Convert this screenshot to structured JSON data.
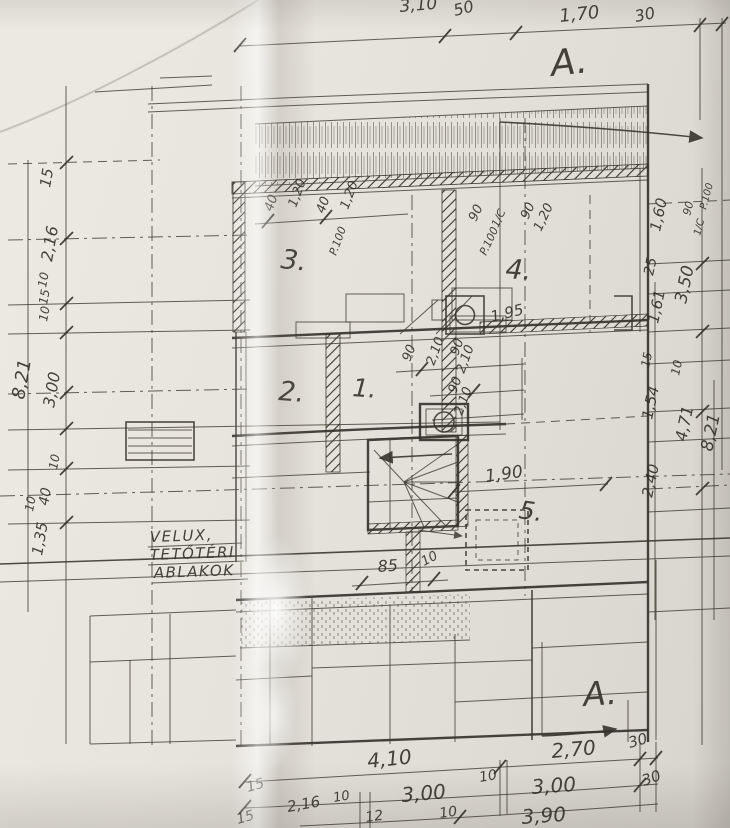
{
  "colors": {
    "paper": "#e7e4dd",
    "paper_bright": "#ece9e2",
    "ink": "#33302a",
    "pencil": "#4a473f"
  },
  "labels": {
    "section_marker": "A.",
    "rooms": {
      "r1": "1.",
      "r2": "2.",
      "r3": "3.",
      "r4": "4.",
      "r5": "5."
    },
    "note": {
      "l1": "VELUX,",
      "l2": "TETŐTÉRI",
      "l3": "ABLAKOK"
    }
  },
  "dims": {
    "top": {
      "d1": "3,10",
      "d2": "50",
      "d3": "1,70",
      "d4": "30"
    },
    "left": {
      "d1": "15",
      "d2": "2,16",
      "d3": "10",
      "d4": "15",
      "d5": "10",
      "d6": "3,00",
      "d7": "8,21",
      "d8": "10",
      "d9": "40",
      "d10": "10",
      "d11": "1,35"
    },
    "right": {
      "d1": "1,60",
      "d2": "25",
      "d3": "3,50",
      "d4": "1,61",
      "d5": "15",
      "d6": "10",
      "d7": "1,54",
      "d8": "4,71",
      "d9": "8,21",
      "d10": "2,40"
    },
    "bottom": {
      "d1": "2,70",
      "d2": "30",
      "d3": "4,10",
      "d4": "10",
      "d5": "3,00",
      "d6": "30",
      "d7": "15",
      "d8": "2,16",
      "d9": "10",
      "d10": "3,00",
      "d11": "12",
      "d12": "10",
      "d13": "3,90",
      "d14": "15"
    },
    "interior": {
      "w3a": "40",
      "w3b": "1,20",
      "w3c": "40",
      "w3d": "1,20",
      "w3p": "P.100",
      "w4a": "90",
      "w4b": "1/C",
      "w4p": "P.100",
      "w4c": "90",
      "w4d": "1,20",
      "wr1": "90",
      "wr2": "P.100",
      "wr3": "1/C",
      "dA1": "90",
      "dA2": "2,10",
      "dB1": "90",
      "dB2": "2,10",
      "dC1": "90",
      "dC2": "2,10",
      "n195": "1,95",
      "n190": "1,90",
      "n85": "85",
      "n10": "10"
    }
  }
}
